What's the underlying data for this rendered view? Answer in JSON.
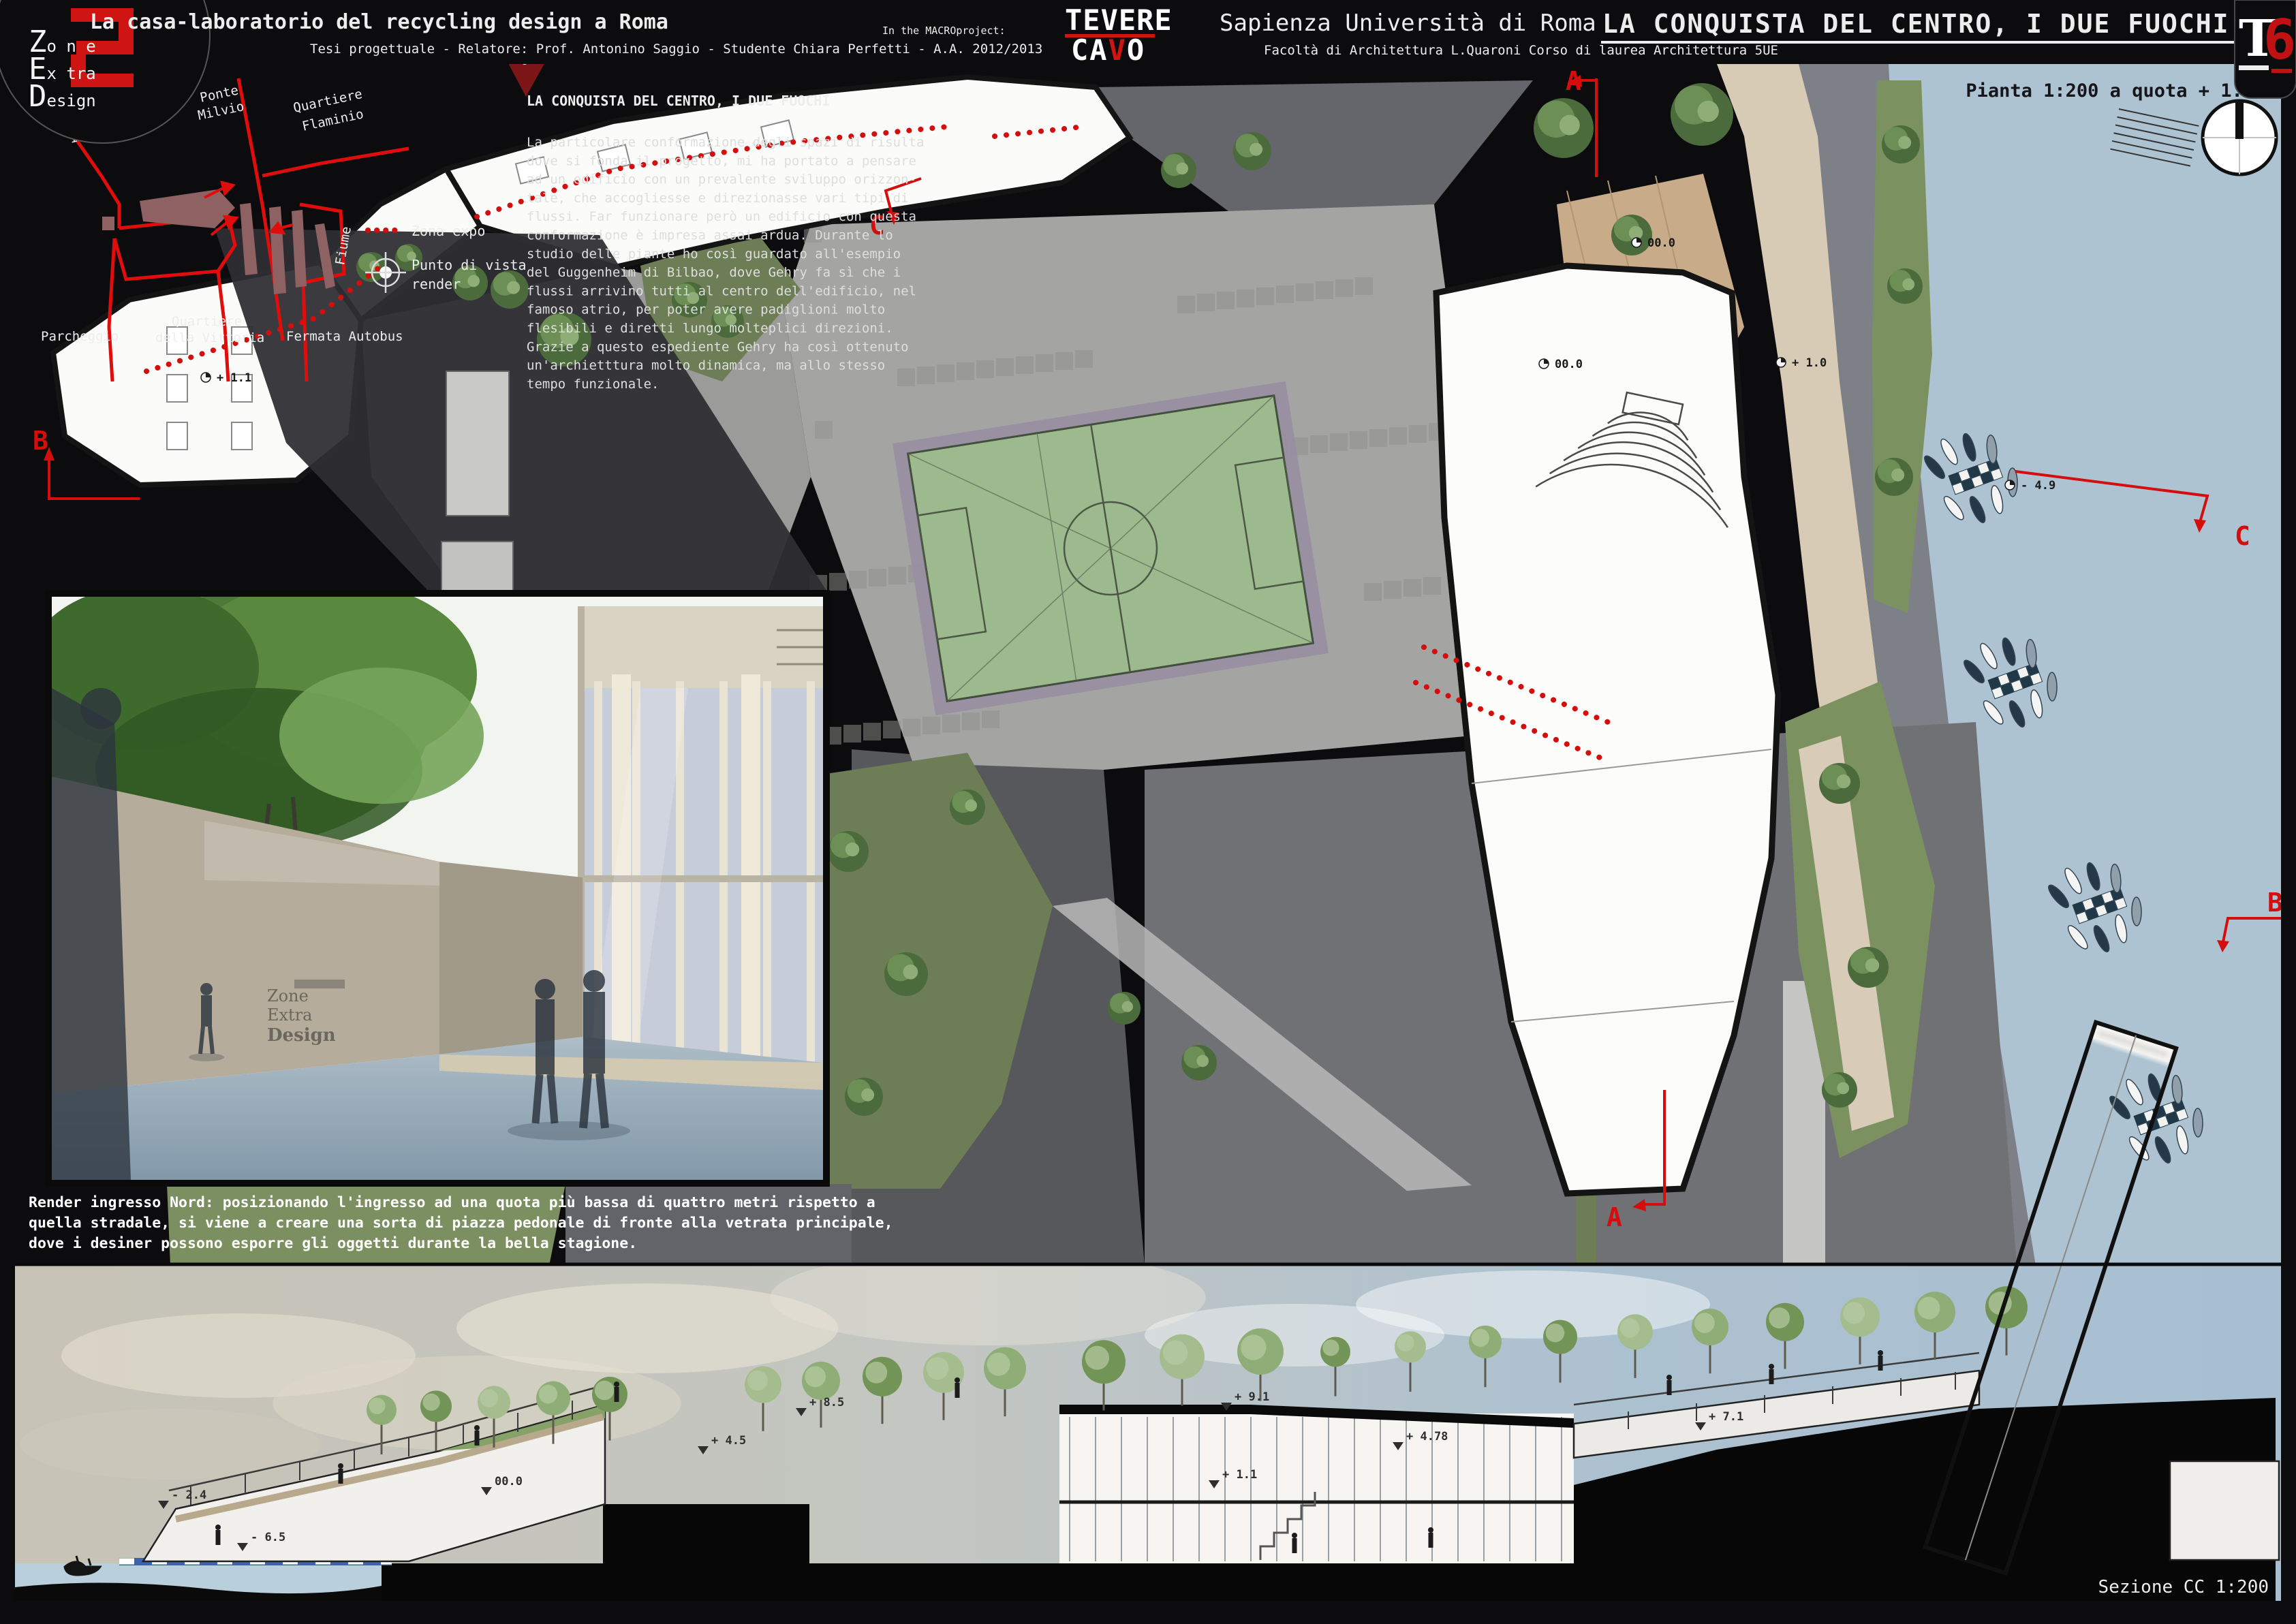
{
  "header": {
    "logo": {
      "l1_cap": "Z",
      "l1_rest": "o n e",
      "l2_cap": "E",
      "l2_rest": "x tra",
      "l3_cap": "D",
      "l3_rest": "esign"
    },
    "title": "La casa-laboratorio del recycling design a Roma",
    "subtitle": "Tesi progettuale - Relatore: Prof. Antonino Saggio - Studente Chiara Perfetti - A.A. 2012/2013",
    "macro_label": "In the MACROproject:",
    "macro_line1": "TEVERE",
    "macro_line2_pre": "CA",
    "macro_line2_v": "V",
    "macro_line2_post": "O",
    "university": "Sapienza Università di Roma",
    "faculty": "Facoltà di Architettura L.Quaroni Corso di laurea Architettura 5UE",
    "board_title": "LA CONQUISTA DEL CENTRO, I DUE FUOCHI",
    "code_letter": "T",
    "code_number": "6"
  },
  "plan": {
    "scale_label": "Pianta 1:200 a quota + 1.5",
    "intro_heading": "LA CONQUISTA DEL CENTRO, I DUE FUOCHI",
    "intro_lines": [
      "La particolare conformazione degli spazi di risulta",
      "dove si fonda il progetto, mi ha portato a pensare",
      "ad un edificio con un prevalente sviluppo orizzon-",
      "tale, che accogliesse e direzionasse vari tipi di",
      "flussi. Far funzionare però un edificio con questa",
      "conformazione è impresa assai ardua. Durante lo",
      "studio delle piante ho così guardato all'esempio",
      "del Guggenheim di Bilbao, dove Gehry fa sì che i",
      "flussi arrivino tutti al centro dell'edificio, nel",
      "famoso atrio, per poter avere padiglioni molto",
      "flesibili e diretti lungo molteplici direzioni.",
      "Grazie a questo espediente Gehry ha così ottenuto",
      "un'archietttura molto dinamica, ma allo stesso",
      "tempo funzionale."
    ],
    "legend_zona": "Zona expo",
    "legend_punto1": "Punto di vista",
    "legend_punto2": "render",
    "locator": {
      "foro1": "Foro",
      "foro2": "Italico",
      "ponte1": "Ponte",
      "ponte2": "Milvio",
      "flaminio1": "Quartiere",
      "flaminio2": "Flaminio",
      "parcheggio": "Parcheggio",
      "vittoria1": "Quartiere",
      "vittoria2": "della Vittoria",
      "fermata": "Fermata Autobus",
      "fiume": "Fiume"
    },
    "markers": {
      "a": "A",
      "b": "B",
      "c": "C"
    },
    "level_marks": [
      "+ 1.1",
      "00.0",
      "00.0",
      "+ 1.0",
      "- 4.9"
    ]
  },
  "render": {
    "caption_lines": [
      "Render ingresso Nord: posizionando l'ingresso ad una quota più bassa di quattro metri rispetto a",
      "quella stradale, si viene a creare una sorta di piazza pedonale di fronte alla vetrata principale,",
      "dove i desiner possono esporre gli oggetti durante la bella stagione."
    ]
  },
  "section": {
    "label": "Sezione CC 1:200",
    "level_marks": [
      "- 2.4",
      "- 6.5",
      "00.0",
      "+ 4.5",
      "+ 8.5",
      "+ 9.1",
      "+ 4.78",
      "+ 1.1",
      "+ 7.1"
    ]
  },
  "colors": {
    "accent_red": "#d40d0d",
    "river": "#aec3d1",
    "field_green": "#9dba8e",
    "olive": "#6d7d55",
    "beige": "#d8cbb5",
    "sky_blue": "#a9c0d3"
  }
}
